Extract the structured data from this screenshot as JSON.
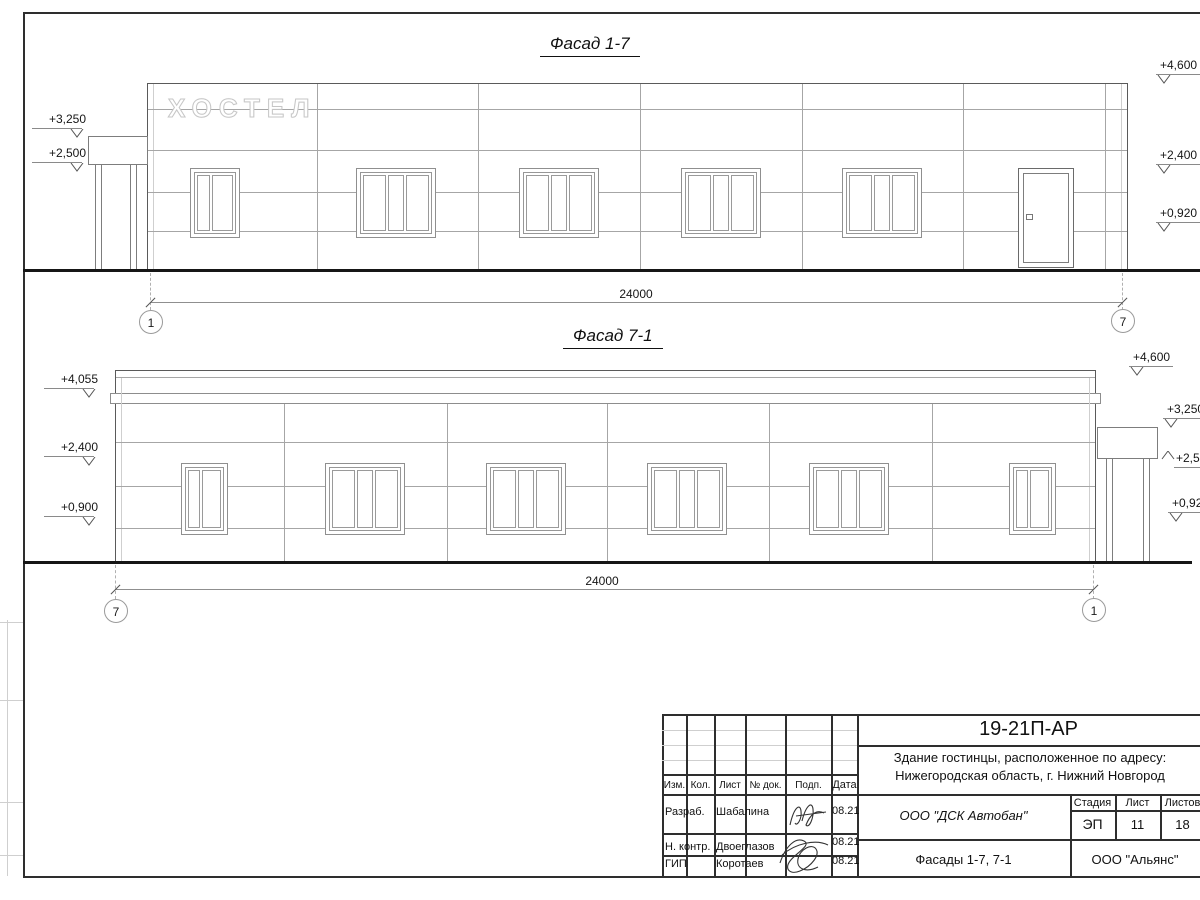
{
  "sheet": {
    "facade1": {
      "title": "Фасад 1-7",
      "sign": "ХОСТЕЛ",
      "marks_left": [
        {
          "value": "+3,250"
        },
        {
          "value": "+2,500"
        }
      ],
      "marks_right": [
        {
          "value": "+4,600"
        },
        {
          "value": "+2,400"
        },
        {
          "value": "+0,920"
        }
      ],
      "dim": "24000",
      "axis_left": "1",
      "axis_right": "7"
    },
    "facade2": {
      "title": "Фасад 7-1",
      "marks_left": [
        {
          "value": "+4,055"
        },
        {
          "value": "+2,400"
        },
        {
          "value": "+0,900"
        }
      ],
      "marks_right": [
        {
          "value": "+4,600"
        },
        {
          "value": "+3,250"
        },
        {
          "value": "+2,500"
        },
        {
          "value": "+0,920"
        }
      ],
      "dim": "24000",
      "axis_left": "7",
      "axis_right": "1"
    },
    "title_block": {
      "doc_number": "19-21П-АР",
      "address_line1": "Здание гостинцы, расположенное по адресу:",
      "address_line2": "Нижегородская область, г. Нижний Новгород",
      "col_izm": "Изм.",
      "col_kol": "Кол.",
      "col_list": "Лист",
      "col_doc": "№ док.",
      "col_podp": "Подп.",
      "col_data": "Дата",
      "rows": [
        {
          "role": "Разраб.",
          "name": "Шабалина",
          "date": "08.21"
        },
        {
          "role": "Н. контр.",
          "name": "Двоеглазов",
          "date": "08.21"
        },
        {
          "role": "ГИП",
          "name": "Коротаев",
          "date": "08.21"
        }
      ],
      "company": "ООО \"ДСК Автобан\"",
      "stage_label": "Стадия",
      "sheet_label": "Лист",
      "sheets_label": "Листов",
      "stage": "ЭП",
      "sheet_no": "11",
      "sheets_total": "18",
      "sheet_title": "Фасады 1-7, 7-1",
      "customer": "ООО \"Альянс\""
    }
  }
}
